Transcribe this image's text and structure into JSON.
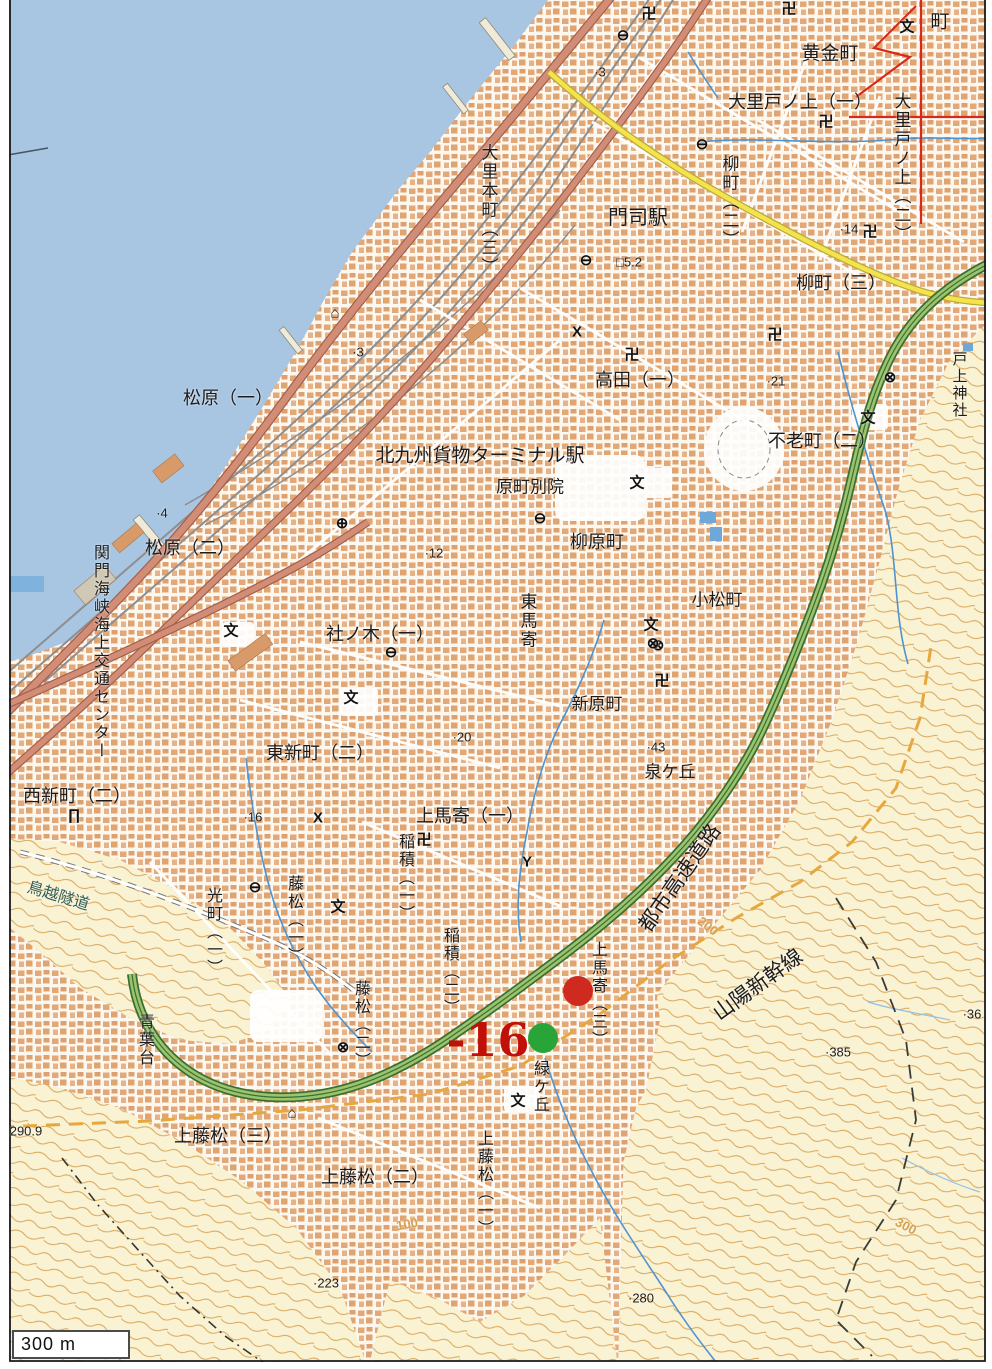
{
  "map": {
    "colors": {
      "sea": "#a8c6e2",
      "hill": "#f9f2d3",
      "contour": "#d7a050",
      "urban-bg": "#fcf8f0",
      "building": "#e2a877",
      "road-red": "#d28d77",
      "road-red-casing": "#a5604c",
      "road-yellow": "#f4e34d",
      "road-yellow-casing": "#b8a93a",
      "expressway-green": "#9cc36d",
      "expressway-casing": "#3a6f33",
      "rail-gray": "#8e8e8e",
      "stream-blue": "#4f93cf",
      "boundary-orange": "#e6a83e",
      "annotation-red": "#d62b1c",
      "marker-red": "#cf2a1f",
      "marker-green": "#28a439",
      "text-black": "#1c1c1c",
      "tunnel-text": "#355e52"
    },
    "labels": [
      {
        "text": "黄金町",
        "x": 830,
        "y": 54,
        "size": 19
      },
      {
        "text": "町",
        "x": 940,
        "y": 22,
        "size": 19
      },
      {
        "text": "大里戸ノ上（一）",
        "x": 800,
        "y": 102,
        "size": 18
      },
      {
        "text": "大里戸ノ上（二）",
        "x": 901,
        "y": 168,
        "size": 17,
        "vert": true
      },
      {
        "text": "柳町（二）",
        "x": 729,
        "y": 202,
        "size": 17,
        "vert": true
      },
      {
        "text": "柳町（三）",
        "x": 841,
        "y": 283,
        "size": 18
      },
      {
        "text": "大里本町（三）",
        "x": 488,
        "y": 210,
        "size": 17,
        "vert": true
      },
      {
        "text": "門司駅",
        "x": 638,
        "y": 218,
        "size": 20
      },
      {
        "text": "松原（一）",
        "x": 228,
        "y": 398,
        "size": 18
      },
      {
        "text": "高田（一）",
        "x": 640,
        "y": 380,
        "size": 18
      },
      {
        "text": "不老町（二）",
        "x": 822,
        "y": 441,
        "size": 18
      },
      {
        "text": "北九州貨物ターミナル駅",
        "x": 480,
        "y": 456,
        "size": 19
      },
      {
        "text": "原町別院",
        "x": 530,
        "y": 487,
        "size": 17
      },
      {
        "text": "柳原町",
        "x": 597,
        "y": 542,
        "size": 18
      },
      {
        "text": "小松町",
        "x": 717,
        "y": 600,
        "size": 17
      },
      {
        "text": "松原（二）",
        "x": 190,
        "y": 548,
        "size": 18
      },
      {
        "text": "関門海峡海上交通センター",
        "x": 99,
        "y": 652,
        "size": 16,
        "vert": true
      },
      {
        "text": "東馬寄",
        "x": 527,
        "y": 621,
        "size": 17,
        "vert": true
      },
      {
        "text": "社ノ木（一）",
        "x": 380,
        "y": 634,
        "size": 18
      },
      {
        "text": "新原町",
        "x": 597,
        "y": 704,
        "size": 17
      },
      {
        "text": "東新町（二）",
        "x": 320,
        "y": 753,
        "size": 18
      },
      {
        "text": "泉ケ丘",
        "x": 670,
        "y": 772,
        "size": 17
      },
      {
        "text": "西新町（二）",
        "x": 77,
        "y": 796,
        "size": 18
      },
      {
        "text": "上馬寄（一）",
        "x": 470,
        "y": 816,
        "size": 18
      },
      {
        "text": "戸上神社",
        "x": 959,
        "y": 385,
        "size": 15,
        "vert": true
      },
      {
        "text": "稲積（一）",
        "x": 404,
        "y": 878,
        "size": 16,
        "vert": true
      },
      {
        "text": "稲積（二）",
        "x": 449,
        "y": 972,
        "size": 16,
        "vert": true
      },
      {
        "text": "光町（一）",
        "x": 212,
        "y": 932,
        "size": 16,
        "vert": true
      },
      {
        "text": "藤松（一）",
        "x": 293,
        "y": 920,
        "size": 16,
        "vert": true
      },
      {
        "text": "藤松（二）",
        "x": 360,
        "y": 1025,
        "size": 16,
        "vert": true
      },
      {
        "text": "青葉台",
        "x": 144,
        "y": 1040,
        "size": 16,
        "vert": true
      },
      {
        "text": "上馬寄（三）",
        "x": 597,
        "y": 995,
        "size": 16,
        "vert": true
      },
      {
        "text": "緑ケ丘",
        "x": 539,
        "y": 1087,
        "size": 16,
        "vert": true
      },
      {
        "text": "上藤松（一）",
        "x": 483,
        "y": 1184,
        "size": 16,
        "vert": true
      },
      {
        "text": "上藤松（三）",
        "x": 228,
        "y": 1136,
        "size": 18
      },
      {
        "text": "上藤松（二）",
        "x": 375,
        "y": 1177,
        "size": 18
      },
      {
        "text": "鳥越隧道",
        "x": 58,
        "y": 897,
        "size": 16,
        "rot": 17,
        "color": "#355e52"
      },
      {
        "text": "都市高速道路",
        "x": 680,
        "y": 878,
        "size": 21,
        "rot": -55
      },
      {
        "text": "山陽新幹線",
        "x": 758,
        "y": 985,
        "size": 21,
        "rot": -36
      }
    ],
    "spot_elevations": [
      {
        "text": "·3",
        "x": 600,
        "y": 72
      },
      {
        "text": "·14",
        "x": 849,
        "y": 229
      },
      {
        "text": "·3",
        "x": 358,
        "y": 352
      },
      {
        "text": "·4",
        "x": 162,
        "y": 513
      },
      {
        "text": "□5.2",
        "x": 629,
        "y": 262
      },
      {
        "text": "·12",
        "x": 434,
        "y": 553
      },
      {
        "text": "·21",
        "x": 776,
        "y": 381
      },
      {
        "text": "·16",
        "x": 253,
        "y": 817
      },
      {
        "text": "·20",
        "x": 462,
        "y": 737
      },
      {
        "text": "·43",
        "x": 656,
        "y": 747
      },
      {
        "text": "·223",
        "x": 326,
        "y": 1283
      },
      {
        "text": "·280",
        "x": 641,
        "y": 1298
      },
      {
        "text": "·385",
        "x": 838,
        "y": 1052
      },
      {
        "text": "·36",
        "x": 972,
        "y": 1014
      },
      {
        "text": "290.9",
        "x": 26,
        "y": 1131
      }
    ],
    "contour_labels": [
      {
        "text": "100",
        "x": 407,
        "y": 1224,
        "rot": -10
      },
      {
        "text": "200",
        "x": 708,
        "y": 926,
        "rot": 38
      },
      {
        "text": "300",
        "x": 906,
        "y": 1226,
        "rot": 28
      }
    ],
    "symbol_glyphs": {
      "temple": "卍",
      "school": "文",
      "police": "⊗",
      "hospital": "⊕",
      "office": "⊖",
      "shrine": "∏",
      "monument": "⌂",
      "koban": "X",
      "fire": "Y"
    },
    "symbols": [
      {
        "type": "temple",
        "x": 649,
        "y": 13
      },
      {
        "type": "temple",
        "x": 789,
        "y": 8
      },
      {
        "type": "temple",
        "x": 826,
        "y": 121
      },
      {
        "type": "temple",
        "x": 870,
        "y": 231
      },
      {
        "type": "temple",
        "x": 632,
        "y": 354
      },
      {
        "type": "temple",
        "x": 775,
        "y": 334
      },
      {
        "type": "temple",
        "x": 424,
        "y": 839
      },
      {
        "type": "temple",
        "x": 662,
        "y": 680
      },
      {
        "type": "school",
        "x": 907,
        "y": 26
      },
      {
        "type": "school",
        "x": 637,
        "y": 482
      },
      {
        "type": "school",
        "x": 868,
        "y": 417
      },
      {
        "type": "school",
        "x": 351,
        "y": 697
      },
      {
        "type": "school",
        "x": 231,
        "y": 630
      },
      {
        "type": "school",
        "x": 651,
        "y": 624
      },
      {
        "type": "school",
        "x": 518,
        "y": 1100
      },
      {
        "type": "school",
        "x": 338,
        "y": 906
      },
      {
        "type": "police",
        "x": 890,
        "y": 377
      },
      {
        "type": "police",
        "x": 658,
        "y": 645
      },
      {
        "type": "police",
        "x": 343,
        "y": 1047
      },
      {
        "type": "police",
        "x": 653,
        "y": 643
      },
      {
        "type": "hospital",
        "x": 342,
        "y": 523
      },
      {
        "type": "office",
        "x": 623,
        "y": 35
      },
      {
        "type": "office",
        "x": 702,
        "y": 144
      },
      {
        "type": "office",
        "x": 586,
        "y": 260
      },
      {
        "type": "office",
        "x": 540,
        "y": 518
      },
      {
        "type": "office",
        "x": 391,
        "y": 652
      },
      {
        "type": "office",
        "x": 255,
        "y": 887
      },
      {
        "type": "shrine",
        "x": 74,
        "y": 815
      },
      {
        "type": "monument",
        "x": 335,
        "y": 313
      },
      {
        "type": "monument",
        "x": 292,
        "y": 1113
      },
      {
        "type": "koban",
        "x": 318,
        "y": 818
      },
      {
        "type": "koban",
        "x": 577,
        "y": 332
      },
      {
        "type": "fire",
        "x": 527,
        "y": 862
      }
    ],
    "markers": [
      {
        "name": "red-circle-marker",
        "x": 578,
        "y": 991,
        "r": 15,
        "color": "#cf2a1f"
      },
      {
        "name": "green-circle-marker",
        "x": 543,
        "y": 1038,
        "r": 15,
        "color": "#28a439"
      }
    ],
    "annotation": {
      "text": "-16",
      "x": 488,
      "y": 1040,
      "size": 46,
      "color": "#c01008"
    },
    "scale_bar": {
      "label": "300 m"
    }
  }
}
